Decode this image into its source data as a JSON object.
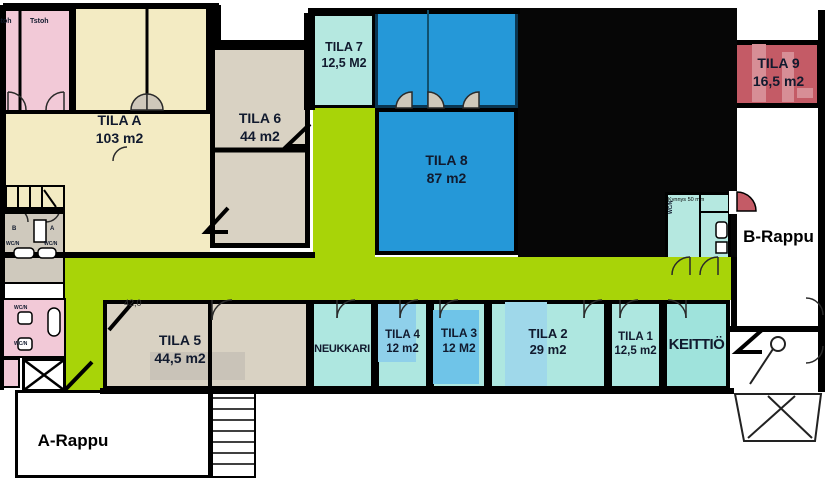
{
  "plan_title": "office floor plan",
  "rooms": {
    "tila_a": {
      "name": "TILA A",
      "area": "103 m2",
      "color": "#f3ebc3"
    },
    "tila_1": {
      "name": "TILA 1",
      "area": "12,5 m2",
      "color": "#aee7e0"
    },
    "tila_2": {
      "name": "TILA 2",
      "area": "29 m2",
      "color": "#aee7e0"
    },
    "tila_3": {
      "name": "TILA 3",
      "area": "12 M2",
      "color": "#aee7e0"
    },
    "tila_4": {
      "name": "TILA 4",
      "area": "12 m2",
      "color": "#aee7e0"
    },
    "tila_5": {
      "name": "TILA 5",
      "area": "44,5 m2",
      "color": "#d9d2c3"
    },
    "tila_6": {
      "name": "TILA 6",
      "area": "44 m2",
      "color": "#d9d2c3"
    },
    "tila_7": {
      "name": "TILA 7",
      "area": "12,5 M2",
      "color": "#b5e8e0"
    },
    "tila_8": {
      "name": "TILA 8",
      "area": "87 m2",
      "color": "#2598d8"
    },
    "tila_9": {
      "name": "TILA 9",
      "area": "16,5 m2",
      "color": "#c45b66"
    },
    "neukkari": {
      "name": "NEUKKARI",
      "color": "#aee7e0"
    },
    "keittio": {
      "name": "KEITTIÖ",
      "color": "#9fe3dc"
    },
    "a_rappu": {
      "name": "A-Rappu",
      "color": "#ffffff"
    },
    "b_rappu": {
      "name": "B-Rappu",
      "color": "#ffffff"
    }
  },
  "annotations": {
    "tstoh_1": "Tstoh",
    "tstoh_2": "Tstoh",
    "dim_tila5": "42,0",
    "kynnys": "Kynnys 50 mm",
    "wc_1": "WC/N",
    "wc_2": "WC/N",
    "wc_3": "WC/N",
    "wc_4": "WC/N",
    "wc_5": "WC/N",
    "unit_b": "B",
    "unit_a": "A"
  },
  "colors": {
    "wall": "#000000",
    "corridor_green": "#a8d408",
    "unassigned_black": "#060606",
    "office_pink": "#f2c9d7",
    "tila_a_cream": "#f3ebc3"
  }
}
